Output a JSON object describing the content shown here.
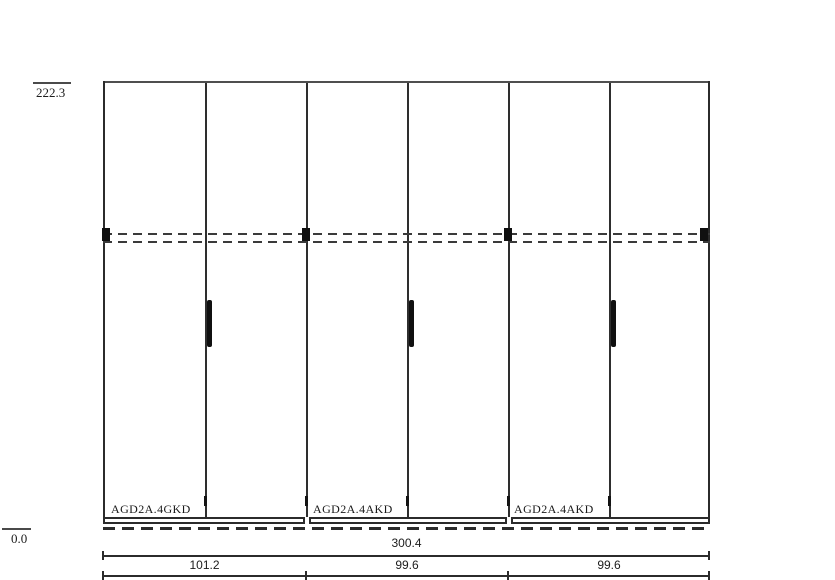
{
  "elevations": {
    "top": "222.3",
    "bottom": "0.0"
  },
  "modules": [
    {
      "label": "AGD2A.4GKD",
      "width": "101.2"
    },
    {
      "label": "AGD2A.4AKD",
      "width": "99.6"
    },
    {
      "label": "AGD2A.4AKD",
      "width": "99.6"
    }
  ],
  "dimensions": {
    "total": "300.4"
  },
  "colors": {
    "line": "#2b2b2b",
    "ink": "#101010",
    "background": "#ffffff"
  }
}
